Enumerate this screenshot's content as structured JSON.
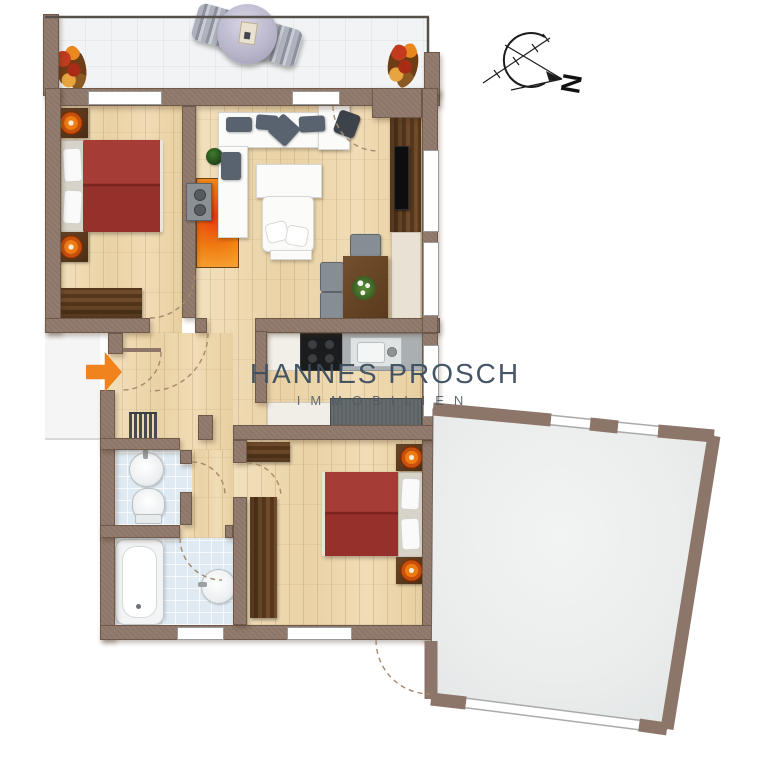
{
  "watermark": {
    "line1": "HANNES PROSCH",
    "line2": "IMMOBILIEN",
    "color": "#3c4d5f"
  },
  "compass": {
    "label": "N",
    "note": "north arrow pointing to lower right"
  },
  "entrance": {
    "marker": "orange-arrow-pointing-right"
  },
  "palette": {
    "wall": "#8d7668",
    "wood_floor": "#eed9b2",
    "balcony_tile": "#f2f3f4",
    "bath_tile": "#dfeaf2",
    "terrace_floor": "#eef0f0",
    "bed_red": "#a13a33",
    "dark_wood": "#5e4124",
    "accent_orange": "#f0831d",
    "counter_gray": "#5c6365",
    "watermark_blue": "#3c4d5f"
  },
  "rooms": [
    {
      "name": "balcony",
      "floor": "light-gray-tile",
      "items": [
        "flower-pot-left",
        "sun-lounger",
        "flower-pot-right"
      ]
    },
    {
      "name": "bedroom-1",
      "floor": "light-wood",
      "items": [
        "red-double-bed",
        "nightstand-with-lamp",
        "nightstand-with-lamp",
        "dark-wood-sideboard"
      ]
    },
    {
      "name": "living-room",
      "floor": "light-wood",
      "items": [
        "white-corner-sofa",
        "gray-cushions",
        "green-plant",
        "white-coffee-table",
        "white-armchair-with-pillows",
        "orange-rug",
        "wall-heater",
        "desk-with-chair",
        "tv-media-wall",
        "cream-tall-cabinet",
        "dining-table-with-chairs",
        "flower-bowl"
      ]
    },
    {
      "name": "kitchen",
      "floor": "light-wood",
      "items": [
        "white-cabinet",
        "black-cooktop",
        "sink-counter",
        "gray-lower-counter"
      ]
    },
    {
      "name": "hallway",
      "floor": "light-wood",
      "items": [
        "entrance-door",
        "radiator"
      ]
    },
    {
      "name": "wc",
      "floor": "blue-tile",
      "items": [
        "washbasin",
        "toilet"
      ]
    },
    {
      "name": "bathroom",
      "floor": "blue-tile",
      "items": [
        "bathtub",
        "washbasin",
        "window"
      ]
    },
    {
      "name": "bedroom-2",
      "floor": "light-wood",
      "items": [
        "red-double-bed",
        "nightstand-with-lamp",
        "nightstand-with-lamp",
        "dark-wood-wardrobe",
        "dark-wood-sideboard",
        "window"
      ]
    },
    {
      "name": "terrace",
      "floor": "light-gray",
      "items": [
        "railing-openings"
      ]
    }
  ]
}
